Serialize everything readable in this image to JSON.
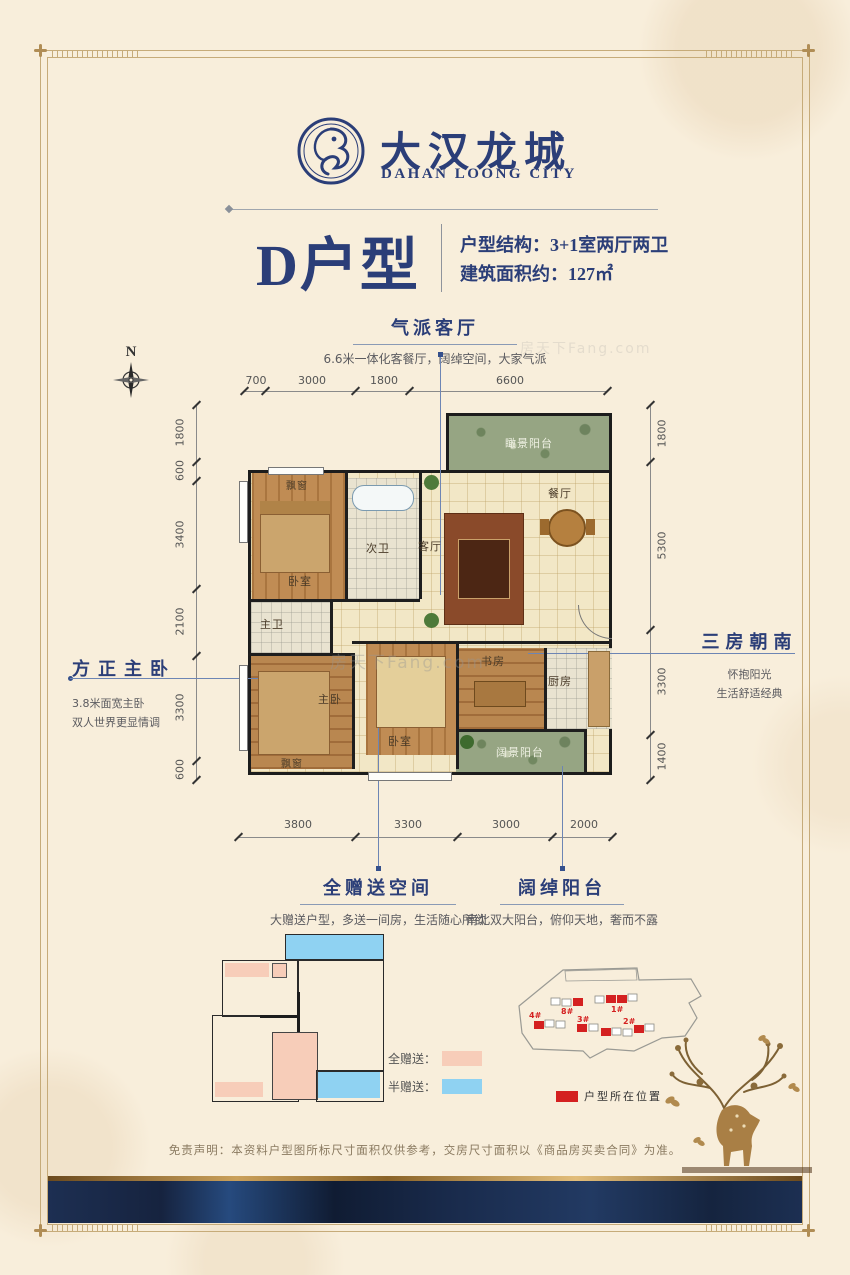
{
  "brand": {
    "emblem": "dragon-seal-emblem",
    "name_cn": "大汉龙城",
    "name_en": "DAHAN LOONG CITY"
  },
  "header": {
    "unit_name": "D户型",
    "spec_structure": "户型结构：3+1室两厅两卫",
    "spec_area": "建筑面积约：127㎡"
  },
  "compass_label": "N",
  "callouts": {
    "living": {
      "title": "气派客厅",
      "desc": "6.6米一体化客餐厅，阔绰空间，大家气派"
    },
    "master": {
      "title": "方正主卧",
      "desc1": "3.8米面宽主卧",
      "desc2": "双人世界更显情调"
    },
    "south": {
      "title": "三房朝南",
      "desc1": "怀抱阳光",
      "desc2": "生活舒适经典"
    },
    "gift": {
      "title": "全赠送空间",
      "desc": "大赠送户型，多送一间房，生活随心所欲"
    },
    "balcony": {
      "title": "阔绰阳台",
      "desc": "南北双大阳台，俯仰天地，奢而不露"
    }
  },
  "dimensions": {
    "top": [
      "700",
      "3000",
      "1800",
      "6600"
    ],
    "bottom": [
      "3800",
      "3300",
      "3000",
      "2000"
    ],
    "left": [
      "1800",
      "600",
      "3400",
      "2100",
      "3300",
      "600"
    ],
    "right": [
      "1800",
      "5300",
      "3300",
      "1400"
    ]
  },
  "rooms": {
    "balcony_top": "瞰景阳台",
    "bay_top": "飘窗",
    "bedroom_top": "卧室",
    "bath_second": "次卫",
    "living": "客厅",
    "dining": "餐厅",
    "bath_master": "主卫",
    "bedroom_master": "主卧",
    "bay_bottom": "飘窗",
    "bedroom_second": "卧室",
    "study": "书房",
    "kitchen": "厨房",
    "balcony_bottom": "阔景阳台"
  },
  "gift_legend": {
    "full_label": "全赠送：",
    "half_label": "半赠送：",
    "full_color": "#f7cdb9",
    "half_color": "#85d0f0"
  },
  "site_plan": {
    "building_labels": [
      "8#",
      "1#",
      "4#",
      "3#",
      "2#"
    ],
    "legend_label": "户型所在位置",
    "highlight_color": "#d42020"
  },
  "disclaimer": "免责声明：本资料户型图所标尺寸面积仅供参考，交房尺寸面积以《商品房买卖合同》为准。",
  "watermark": "房天下Fang.com",
  "colors": {
    "navy": "#2b3e78",
    "leader_blue": "#6d85b4",
    "gold": "#b08d55"
  }
}
